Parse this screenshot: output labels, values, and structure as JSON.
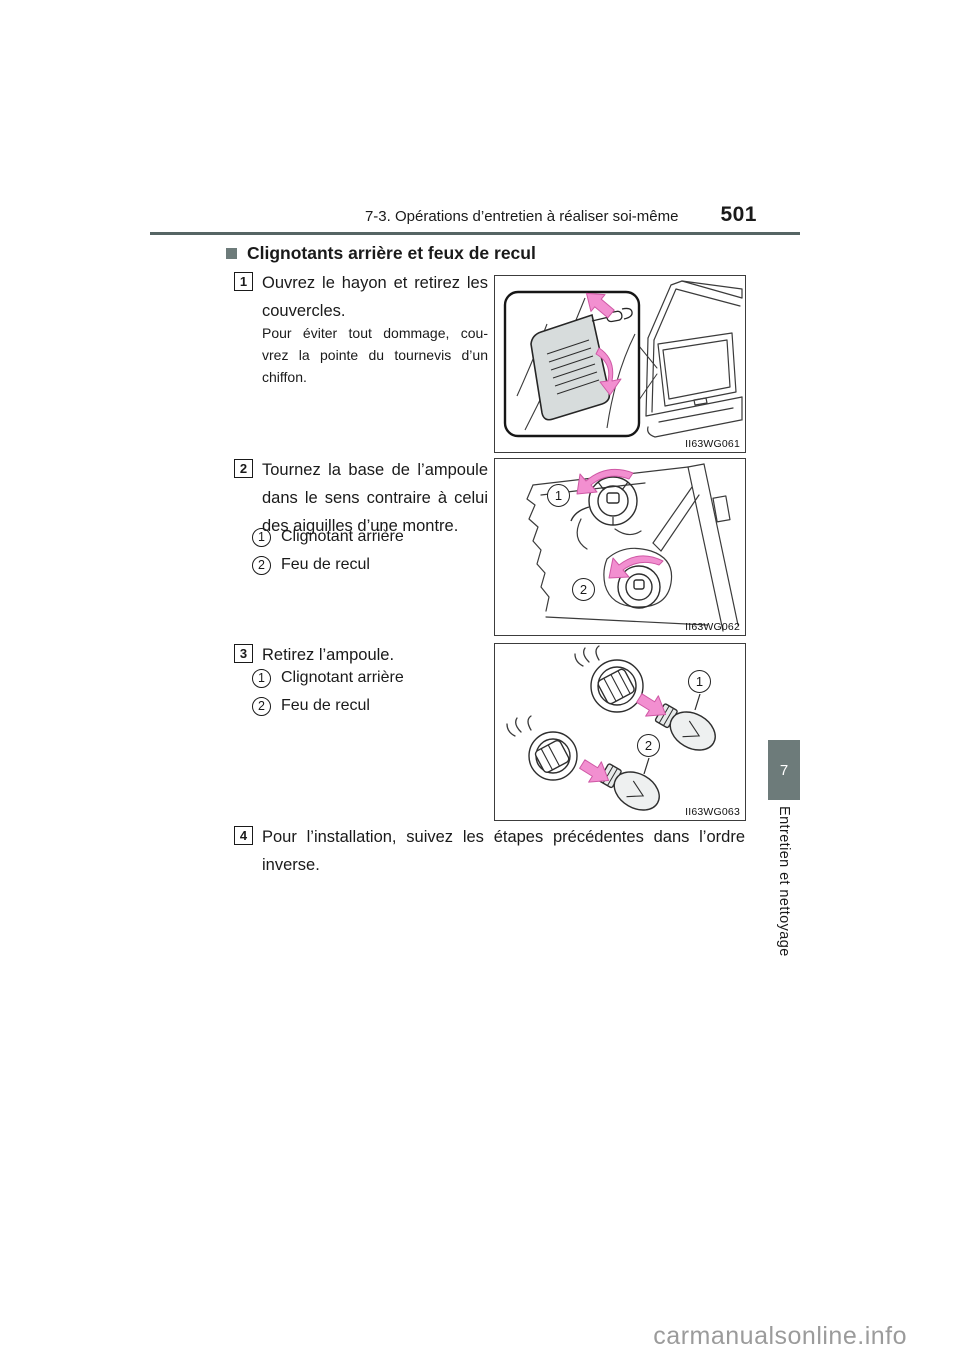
{
  "header": {
    "running_title": "7-3. Opérations d’entretien à réaliser soi-même",
    "page_number": "501"
  },
  "section": {
    "title": "Clignotants arrière et feux de recul"
  },
  "steps": [
    {
      "num": "1",
      "lines": [
        "Ouvrez le hayon et retirez les",
        "couvercles."
      ],
      "note_lines": [
        "Pour éviter tout dommage, cou-",
        "vrez la pointe du tournevis d’un",
        "chiffon."
      ]
    },
    {
      "num": "2",
      "lines": [
        "Tournez la base de l’ampoule",
        "dans le sens contraire à celui",
        "des aiguilles d’une montre."
      ],
      "items": [
        {
          "num": "1",
          "label": "Clignotant arrière"
        },
        {
          "num": "2",
          "label": "Feu de recul"
        }
      ]
    },
    {
      "num": "3",
      "lines": [
        "Retirez l’ampoule."
      ],
      "items": [
        {
          "num": "1",
          "label": "Clignotant arrière"
        },
        {
          "num": "2",
          "label": "Feu de recul"
        }
      ]
    },
    {
      "num": "4",
      "lines": [
        "Pour l’installation, suivez les étapes précédentes dans l’ordre",
        "inverse."
      ]
    }
  ],
  "figures": [
    {
      "caption": "II63WG061"
    },
    {
      "caption": "II63WG062",
      "markers": [
        "1",
        "2"
      ]
    },
    {
      "caption": "II63WG063",
      "markers": [
        "1",
        "2"
      ]
    }
  ],
  "sidebar": {
    "chapter_number": "7",
    "chapter_title": "Entretien et nettoyage"
  },
  "watermark": "carmanualsonline.info",
  "colors": {
    "accent_slate": "#6d7b7a",
    "arrow_pink": "#f28fd0"
  }
}
